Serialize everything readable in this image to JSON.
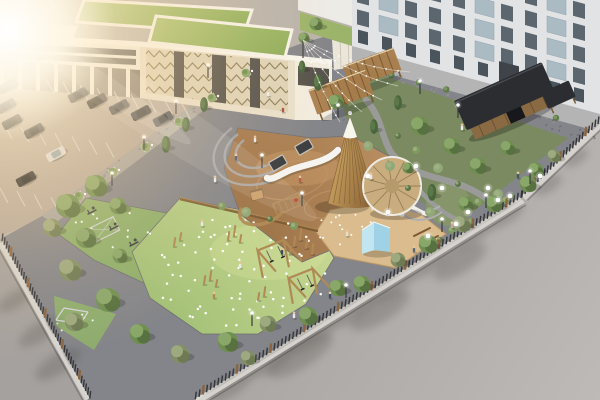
{
  "meta": {
    "description": "Aerial 3D architectural rendering of a landscaped courtyard playground: office building with green roofs and chevron facade panels, parking lot with cars, fenced park with wooden teepee tower, slides, swings, rubber play surfaces with embedded lights, sand pit with blue tent, round canopy, garden with black-roofed wooden pavilion, pergolas, string lights, apartment building and a gray road with tree shadows, warm sun flare from top-left"
  },
  "palette": {
    "base": "#b9b3ac",
    "parking": "#b6a99c",
    "curb": "#dbd8d2",
    "pave": "#84858a",
    "walkway": "#a8a5a0",
    "sidewalk": "#b5b4b4",
    "lawn": "#9cb36a",
    "fitness": "#8fb06b",
    "sand": "#dabc8e",
    "garden": "#7b8a60",
    "gardenLawn": "#87966a",
    "path": "#9c9c9e",
    "cream": "#e9e0cc",
    "creamL": "#f2ecdf",
    "panel": "#ded3b8",
    "panelLine": "#8f7e59",
    "darkglass": "#55524c",
    "white": "#f8f5ed",
    "roofWhite": "#f4f0e6",
    "apt": "#e2e3e5",
    "aptWin": "#5c666f",
    "aptGlass": "#a9b9c3",
    "aptEntry": "#3f444a",
    "wood": "#b08a56",
    "woodMid": "#a87c4a",
    "woodDark": "#7c5a34",
    "canopy": "#c9ad7e",
    "canopyLine": "#8a744e",
    "pavRoof": "#2b2d31",
    "pavWall": "#8a6a42",
    "tentA": "#c2e6f0",
    "tentB": "#9ed2e4",
    "slide": "#f6f4f0",
    "metal": "#d2d5d7",
    "dark": "#3e4044",
    "fence": "#34353a",
    "fencePost": "#8a6540",
    "fenceBase": "#d6d3ce",
    "treeA": "#6f8f52",
    "treeB": "#8aa76a",
    "treeC": "#556f3f",
    "oliveA": "#828f66",
    "oliveB": "#9da97f",
    "oliveC": "#6b7852",
    "pineA": "#49653c",
    "pineB": "#5d7a4a",
    "roadA": "#a5a19e",
    "roadB": "#bdbab7",
    "rubberA": "#9b7147",
    "rubberB": "#bb9061",
    "fieldA": "#9fbe74",
    "fieldB": "#c8d792",
    "roofA": "#a9c171",
    "roofB": "#8cab58",
    "teeA": "#d2aa66",
    "teeB": "#8a6436",
    "skin": "#e8c6a0"
  },
  "scene": {
    "trees": [
      [
        204,
        106,
        7,
        "p"
      ],
      [
        186,
        126,
        7,
        "p"
      ],
      [
        166,
        146,
        8,
        "p"
      ],
      [
        96,
        186,
        12,
        "d"
      ],
      [
        68,
        206,
        13,
        "d"
      ],
      [
        52,
        228,
        10,
        "o"
      ],
      [
        118,
        206,
        9,
        "d"
      ],
      [
        86,
        238,
        11,
        "d"
      ],
      [
        70,
        270,
        12,
        "o"
      ],
      [
        108,
        300,
        13,
        "d"
      ],
      [
        74,
        322,
        10,
        "o"
      ],
      [
        140,
        334,
        11,
        "d"
      ],
      [
        180,
        354,
        10,
        "o"
      ],
      [
        120,
        256,
        8,
        "d"
      ],
      [
        228,
        342,
        11,
        "d"
      ],
      [
        268,
        324,
        9,
        "o"
      ],
      [
        308,
        316,
        10,
        "d"
      ],
      [
        248,
        358,
        8,
        "o"
      ],
      [
        338,
        288,
        9,
        "d"
      ],
      [
        362,
        284,
        9,
        "d"
      ],
      [
        398,
        260,
        8,
        "o"
      ],
      [
        428,
        244,
        10,
        "d"
      ],
      [
        462,
        224,
        9,
        "o"
      ],
      [
        494,
        204,
        9,
        "d"
      ],
      [
        528,
        184,
        9,
        "d"
      ],
      [
        554,
        156,
        7,
        "o"
      ],
      [
        420,
        126,
        10,
        "d"
      ],
      [
        452,
        146,
        9,
        "d"
      ],
      [
        478,
        166,
        9,
        "d"
      ],
      [
        508,
        148,
        8,
        "d"
      ],
      [
        536,
        170,
        8,
        "d"
      ],
      [
        432,
        194,
        8,
        "p"
      ],
      [
        466,
        204,
        8,
        "d"
      ],
      [
        398,
        104,
        7,
        "p"
      ],
      [
        374,
        128,
        7,
        "p"
      ],
      [
        318,
        84,
        8,
        "p"
      ],
      [
        336,
        102,
        8,
        "d"
      ],
      [
        302,
        68,
        6,
        "p"
      ],
      [
        316,
        24,
        7,
        "d"
      ],
      [
        304,
        38,
        6,
        "d"
      ],
      [
        408,
        168,
        6,
        "d"
      ]
    ],
    "cars": [
      [
        78,
        95,
        "#2c2e33",
        "#191b1f"
      ],
      [
        97,
        101,
        "#23252a",
        "#141619"
      ],
      [
        119,
        107,
        "#3a3f46",
        "#1c2025"
      ],
      [
        141,
        113,
        "#24262b",
        "#15171b"
      ],
      [
        163,
        119,
        "#4a4e55",
        "#24272c"
      ],
      [
        8,
        86,
        "#2c2e33",
        "#17191d"
      ],
      [
        12,
        122,
        "#1d1f23",
        "#101214"
      ],
      [
        34,
        131,
        "#33363c",
        "#1a1d21"
      ],
      [
        56,
        154,
        "#d9dbdd",
        "#8fa0ab"
      ],
      [
        26,
        179,
        "#212328",
        "#121418"
      ],
      [
        6,
        106,
        "#30333a",
        "#181b20"
      ]
    ],
    "parkingRows": [
      {
        "x": 54,
        "y": 94,
        "dx": 17,
        "dy": 3.1,
        "n": 9,
        "lx": -8,
        "ly": -15
      },
      {
        "x": 4,
        "y": 124,
        "dx": 17,
        "dy": 3.1,
        "n": 7,
        "lx": 8,
        "ly": 15
      },
      {
        "x": 0,
        "y": 188,
        "dx": 17,
        "dy": 3.1,
        "n": 4,
        "lx": 8,
        "ly": 15
      }
    ],
    "fences": [
      {
        "x1": 521,
        "y1": 197,
        "x2": 194,
        "y2": 399,
        "step": 4.4,
        "post": 9,
        "ox": 2.6,
        "oy": 4.2
      },
      {
        "x1": 598,
        "y1": 123,
        "x2": 521,
        "y2": 197,
        "step": 4.4,
        "post": 8,
        "ox": 3.4,
        "oy": 1.8
      },
      {
        "x1": 2,
        "y1": 240,
        "x2": 90,
        "y2": 398,
        "step": 4.4,
        "post": 8,
        "ox": -3.4,
        "oy": 1.9
      }
    ],
    "dotFields": [
      {
        "cx": 238,
        "cy": 270,
        "rx": 92,
        "ry": 56,
        "n": 74,
        "r": 1.25,
        "seed": 7
      },
      {
        "cx": 350,
        "cy": 230,
        "rx": 36,
        "ry": 17,
        "n": 14,
        "r": 1,
        "seed": 11
      },
      {
        "cx": 112,
        "cy": 230,
        "rx": 40,
        "ry": 24,
        "n": 12,
        "r": 1.1,
        "seed": 13
      },
      {
        "cx": 74,
        "cy": 322,
        "rx": 24,
        "ry": 13,
        "n": 7,
        "r": 1,
        "seed": 17
      }
    ],
    "speckleFields": [
      {
        "x0": 228,
        "x1": 352,
        "yB": 8,
        "slope": 0.26,
        "spread": 36,
        "n": 40,
        "seed": 21,
        "c": "#6d6d71"
      },
      {
        "x0": 60,
        "x1": 246,
        "yB": 247,
        "slope": -0.74,
        "spread": 9,
        "n": 22,
        "seed": 23,
        "c": "#77777b"
      },
      {
        "x0": 360,
        "x1": 588,
        "yB": -31.6,
        "slope": 0.266,
        "spread": 10,
        "n": 26,
        "seed": 27,
        "c": "#9a9a9c"
      },
      {
        "x0": 536,
        "x1": 596,
        "yB": -60,
        "slope": 0.32,
        "spread": 14,
        "n": 16,
        "seed": 29,
        "c": "#5f5f63"
      }
    ],
    "shadowBlobs": [
      [
        230,
        387,
        26,
        9
      ],
      [
        270,
        362,
        26,
        9
      ],
      [
        310,
        337,
        26,
        9
      ],
      [
        350,
        313,
        26,
        9
      ],
      [
        390,
        288,
        26,
        9
      ],
      [
        430,
        263,
        26,
        9
      ],
      [
        470,
        238,
        24,
        8
      ],
      [
        505,
        216,
        22,
        8
      ],
      [
        548,
        185,
        16,
        7
      ],
      [
        576,
        158,
        14,
        6
      ],
      [
        300,
        355,
        38,
        13
      ],
      [
        380,
        310,
        34,
        12
      ],
      [
        460,
        262,
        30,
        11
      ],
      [
        15,
        300,
        20,
        8
      ],
      [
        40,
        332,
        24,
        9
      ],
      [
        58,
        364,
        26,
        10
      ]
    ],
    "planters": [
      [
        246,
        73
      ],
      [
        212,
        98
      ],
      [
        179,
        122
      ],
      [
        146,
        147
      ],
      [
        113,
        172
      ],
      [
        79,
        196
      ]
    ],
    "gardenShrubs": [
      [
        398,
        136
      ],
      [
        416,
        150
      ],
      [
        438,
        168
      ],
      [
        458,
        184
      ],
      [
        478,
        202
      ],
      [
        430,
        212
      ],
      [
        408,
        188
      ],
      [
        452,
        230
      ],
      [
        498,
        194
      ],
      [
        512,
        196
      ],
      [
        470,
        222
      ],
      [
        390,
        166
      ],
      [
        528,
        182
      ],
      [
        506,
        200
      ],
      [
        368,
        146
      ],
      [
        440,
        240
      ],
      [
        222,
        206
      ],
      [
        246,
        212
      ],
      [
        270,
        219
      ],
      [
        294,
        226
      ]
    ],
    "woodPosts": [
      [
        294,
        246,
        9
      ],
      [
        300,
        240,
        11
      ],
      [
        306,
        248,
        8
      ],
      [
        312,
        254,
        10
      ],
      [
        290,
        254,
        7
      ],
      [
        228,
        240,
        8
      ],
      [
        234,
        236,
        10
      ],
      [
        240,
        242,
        7
      ],
      [
        204,
        284,
        8
      ],
      [
        210,
        280,
        9
      ],
      [
        216,
        286,
        6
      ],
      [
        258,
        300,
        7
      ],
      [
        264,
        296,
        9
      ],
      [
        180,
        240,
        7
      ],
      [
        174,
        246,
        8
      ]
    ],
    "equip": [
      [
        92,
        212
      ],
      [
        114,
        228
      ],
      [
        134,
        244
      ]
    ],
    "lamps": [
      [
        208,
        78
      ],
      [
        176,
        114
      ],
      [
        144,
        150
      ],
      [
        112,
        186
      ],
      [
        338,
        118
      ],
      [
        302,
        206
      ],
      [
        262,
        168
      ],
      [
        346,
        298
      ],
      [
        442,
        232
      ],
      [
        486,
        208
      ],
      [
        530,
        184
      ],
      [
        420,
        94
      ],
      [
        458,
        118
      ],
      [
        252,
        326
      ]
    ],
    "globes": [
      [
        416,
        166
      ],
      [
        442,
        188
      ],
      [
        468,
        212
      ],
      [
        428,
        236
      ],
      [
        488,
        188
      ],
      [
        540,
        176
      ],
      [
        498,
        200
      ],
      [
        388,
        212
      ],
      [
        368,
        176
      ],
      [
        456,
        224
      ],
      [
        510,
        196
      ]
    ],
    "stringLights": {
      "pole": [
        303,
        40
      ],
      "targets": [
        [
          340,
          122
        ],
        [
          362,
          112
        ],
        [
          382,
          100
        ],
        [
          398,
          86
        ],
        [
          410,
          72
        ]
      ],
      "sag": 12,
      "dots": 8
    },
    "people": [
      [
        268,
        96,
        "#ececec"
      ],
      [
        283,
        112,
        "#a84d44"
      ],
      [
        255,
        142,
        "#e8e8e8"
      ],
      [
        236,
        160,
        "#44526a"
      ],
      [
        215,
        182,
        "#ececec"
      ],
      [
        202,
        226,
        "#e8e8e8"
      ],
      [
        347,
        236,
        "#e6ddcb"
      ],
      [
        282,
        254,
        "#3c4a62"
      ],
      [
        240,
        268,
        "#ececec"
      ],
      [
        214,
        298,
        "#b08a56"
      ],
      [
        294,
        318,
        "#e8e8e8"
      ],
      [
        414,
        252,
        "#5a6a7c"
      ],
      [
        371,
        179,
        "#ececec"
      ],
      [
        452,
        228,
        "#c9a6a0"
      ],
      [
        518,
        178,
        "#46566a"
      ],
      [
        462,
        130,
        "#ececec"
      ],
      [
        300,
        182,
        "#c05a50"
      ],
      [
        330,
        298,
        "#3f4e66"
      ]
    ],
    "hedgeRow": {
      "x1": 364,
      "y1": 68,
      "x2": 556,
      "y2": 118,
      "n": 8,
      "r": 3.2
    },
    "teepee": {
      "ax": 350,
      "ay": 117,
      "blx": 328,
      "bly": 203,
      "brx": 377,
      "bry": 205,
      "n": 9
    },
    "canopy": {
      "cx": 392,
      "cy": 186,
      "r": 29,
      "spokes": 11
    },
    "apartment": {
      "windows": {
        "x": 352,
        "skew": 14.9,
        "cols": 10,
        "colW": 24,
        "rows": [
          -58,
          -36,
          -14,
          8
        ],
        "winW": 12,
        "winH": 15,
        "glassW": 19,
        "glassCols": [
          1,
          5,
          8
        ],
        "ground": {
          "y": 28,
          "h": 13
        },
        "entrance": {
          "col": 6,
          "y": 22,
          "h": 24,
          "w": 20
        }
      }
    }
  }
}
